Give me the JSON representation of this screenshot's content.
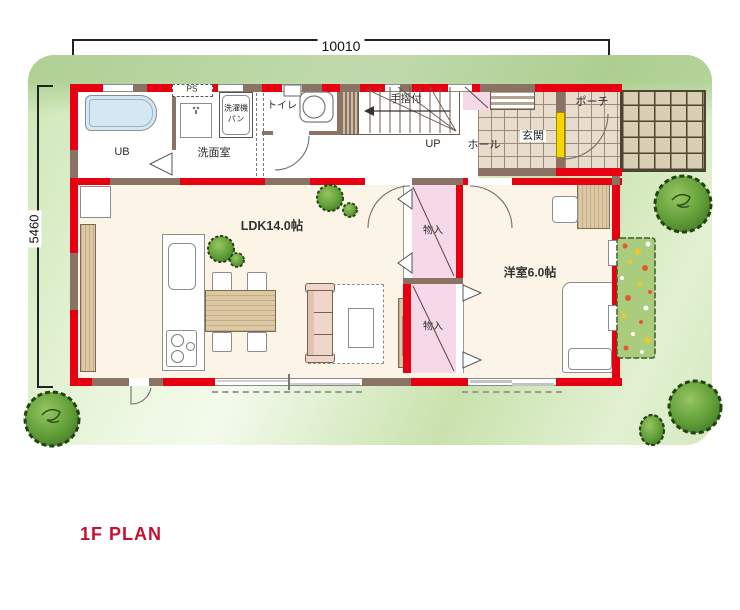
{
  "title": "1F PLAN",
  "dimensions": {
    "width": "10010",
    "height": "5460"
  },
  "labels": {
    "ub": "UB",
    "senmen": "洗面室",
    "ps": "PS",
    "sentakuki_line1": "洗濯機",
    "sentakuki_line2": "パン",
    "toilet": "トイレ",
    "handrail": "手摺付",
    "up": "UP",
    "hall": "ホール",
    "genkan": "玄関",
    "porch": "ポーチ",
    "ldk": "LDK14.0帖",
    "storage_upper": "物入",
    "storage_lower": "物入",
    "western_room": "洋室6.0帖"
  },
  "colors": {
    "wall_red": "#e60012",
    "wall_brown": "#8a7264",
    "title_red": "#c41230",
    "lawn_green": "#cde6b6",
    "tree_green": "#5f9c3c",
    "tile_beige": "#e8ddcc",
    "closet_pink": "#f6d9e8",
    "front_door_yellow": "#f6d500",
    "bathtub_blue": "#d3e8f3",
    "wood": "#dcc9a4"
  }
}
